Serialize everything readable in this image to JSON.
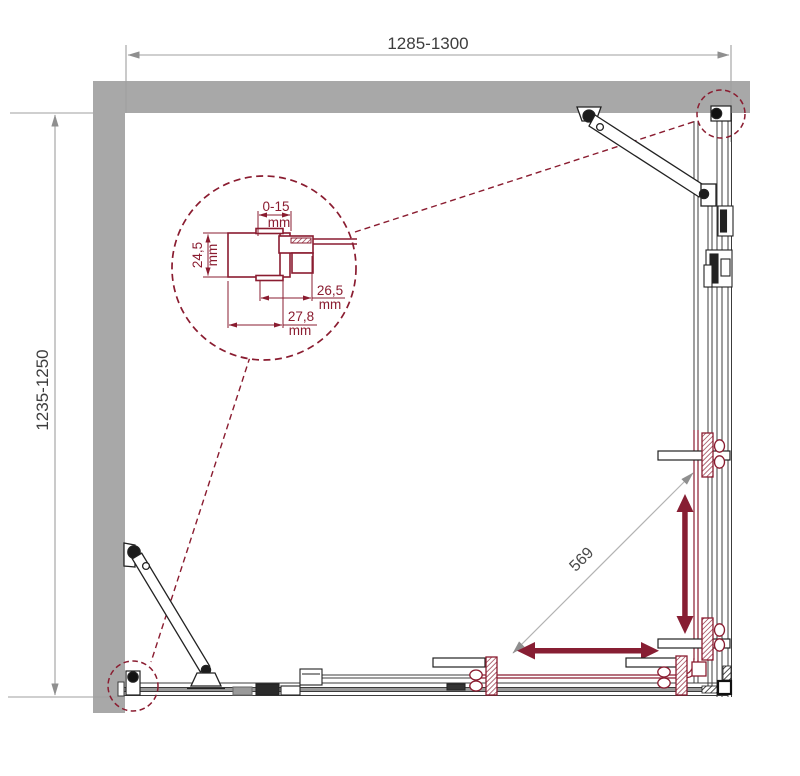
{
  "dimensions": {
    "width": "1285-1300",
    "depth": "1235-1250",
    "diagonal": "569"
  },
  "profile_detail": {
    "adjustment": "0-15",
    "adjustment_unit": "mm",
    "profile_depth": "24,5",
    "profile_depth_unit": "mm",
    "inner_width": "26,5",
    "inner_width_unit": "mm",
    "outer_width": "27,8",
    "outer_width_unit": "mm"
  },
  "colors": {
    "accent_maroon": "#8a1c30",
    "arrow_maroon": "#871e33",
    "wall_gray": "#a8a8a8",
    "dim_line_gray": "#9f9f9f",
    "dim_text": "#3d3d3d",
    "frame_line": "#3c3c3c"
  }
}
